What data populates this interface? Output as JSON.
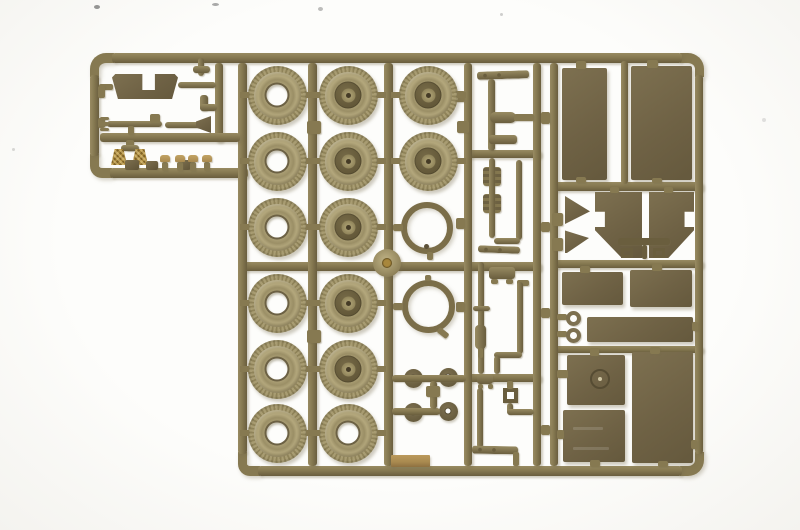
{
  "scene": {
    "type": "photograph",
    "subject": "injection-molded plastic model kit sprue",
    "background": "white seamless studio background",
    "description": "Olive-drab plastic model kit sprue (parts frame) holding truck tires and hubbed wheels, spare-tire rings, flat hull and body panels, fenders, chassis rods, eyelets and small fittings, photographed on a white background"
  },
  "colors": {
    "background": "#fdfdfb",
    "runner": "#867951",
    "runner_light": "#988b62",
    "runner_dark": "#6a5e3e",
    "panel": "#6f6245",
    "panel_light": "#7d7050",
    "tire": "#a89c72",
    "tire_dark": "#8f8359",
    "tire_light": "#b3a77c",
    "hub": "#615637",
    "hub_cap": "#a3976b",
    "tan": "#a8894f",
    "brass": "#a8873c",
    "shadow": "rgba(120,108,78,0.35)"
  },
  "inventory": {
    "plain_tires": 7,
    "hubbed_wheels": 7,
    "spare_tire_rings": 2,
    "small_discs": 4,
    "hub_dome": 1,
    "large_flat_panels": 9,
    "fender_panels": 2,
    "eyelets": 2,
    "gold_fittings": 2,
    "description": "wheels, tires, hull panels, fenders, chassis rods, tools and fittings on one sprue"
  },
  "wheel_grid": {
    "columns_x": [
      277,
      348,
      428
    ],
    "rows_y": [
      95,
      161,
      227,
      303,
      369,
      433
    ],
    "tire_diameter": 59,
    "cells": [
      [
        "tire",
        "wheel",
        "wheel"
      ],
      [
        "tire",
        "wheel",
        "wheel"
      ],
      [
        "tire",
        "wheel",
        null
      ],
      [
        "tire",
        "wheel",
        null
      ],
      [
        "tire",
        "wheel",
        null
      ],
      [
        "tire",
        "tire",
        null
      ]
    ]
  },
  "rings": [
    {
      "cx": 427,
      "cy": 228,
      "outer_d": 52
    },
    {
      "cx": 428,
      "cy": 306,
      "outer_d": 53
    }
  ],
  "discs": [
    {
      "cx": 413,
      "cy": 378
    },
    {
      "cx": 448,
      "cy": 377
    },
    {
      "cx": 413,
      "cy": 412
    },
    {
      "cx": 448,
      "cy": 411
    }
  ],
  "hub_dome": {
    "cx": 387,
    "cy": 263,
    "d": 28
  }
}
